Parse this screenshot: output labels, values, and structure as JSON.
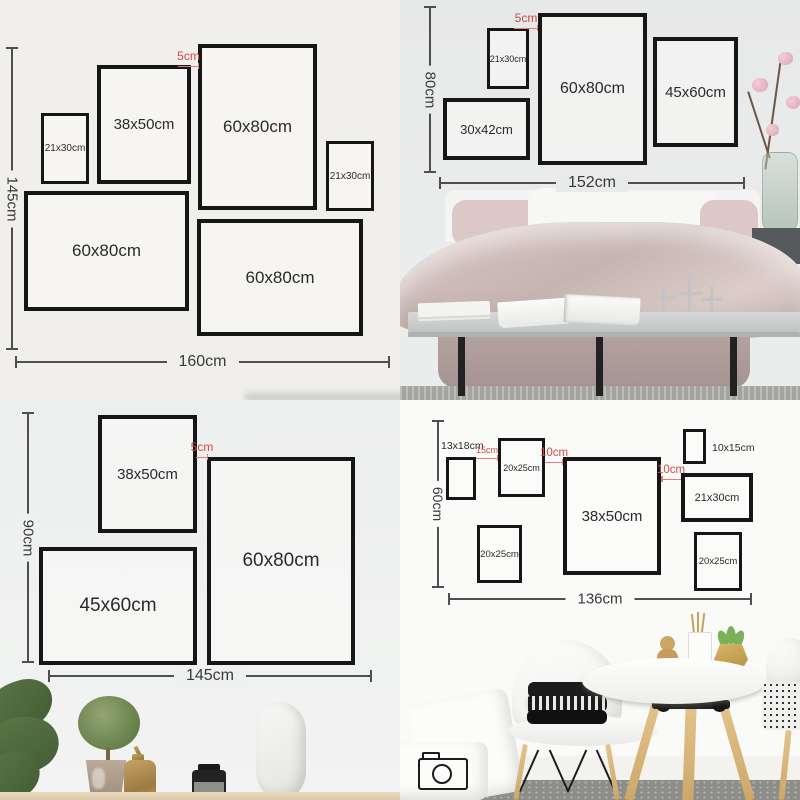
{
  "colors": {
    "frame_border": "#161616",
    "dimension_line": "#4f4f4f",
    "red_accent": "#cf4a45"
  },
  "top_left": {
    "height_total": "145cm",
    "width_total": "160cm",
    "gap": "5cm",
    "frames": [
      {
        "label": "21x30cm"
      },
      {
        "label": "38x50cm"
      },
      {
        "label": "60x80cm"
      },
      {
        "label": "21x30cm"
      },
      {
        "label": "60x80cm"
      },
      {
        "label": "60x80cm"
      }
    ]
  },
  "top_right": {
    "height_total": "80cm",
    "width_total": "152cm",
    "gap": "5cm",
    "frames": [
      {
        "label": "21x30cm"
      },
      {
        "label": "60x80cm"
      },
      {
        "label": "45x60cm"
      },
      {
        "label": "30x42cm"
      }
    ]
  },
  "bottom_left": {
    "height_total": "90cm",
    "width_total": "145cm",
    "gap": "5cm",
    "frames": [
      {
        "label": "38x50cm"
      },
      {
        "label": "60x80cm"
      },
      {
        "label": "45x60cm"
      }
    ]
  },
  "bottom_right": {
    "height_total": "60cm",
    "width_total": "136cm",
    "gaps": [
      "15cm",
      "10cm",
      "10cm"
    ],
    "frame_13x18_label": "13x18cm",
    "frame_10x15_label": "10x15cm",
    "frames": [
      {
        "label": "20x25cm"
      },
      {
        "label": "38x50cm"
      },
      {
        "label": "21x30cm"
      },
      {
        "label": "20x25cm"
      },
      {
        "label": "20x25cm"
      }
    ]
  }
}
